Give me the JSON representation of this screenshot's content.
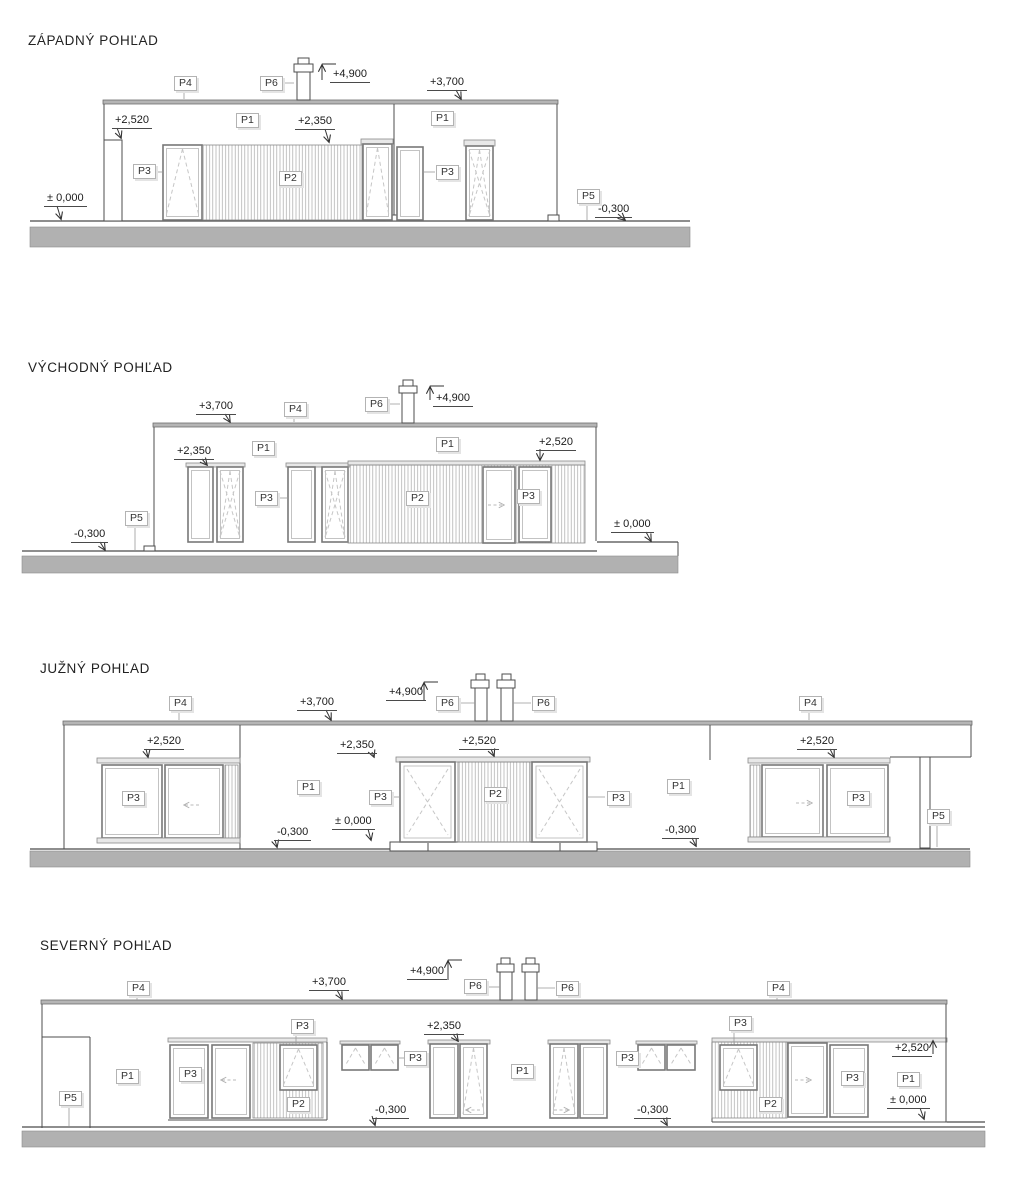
{
  "drawing": {
    "type": "building-elevations",
    "sheet_background": "#ffffff"
  },
  "colors": {
    "line": "#4d4d4d",
    "frame": "#787878",
    "frame_inner": "#bdbdbd",
    "hatch": "#a8a8a8",
    "dash": "#c6c6c6",
    "ground": "#b1b1b1",
    "roof": "#b5b5b5",
    "leader": "#999999",
    "arrow": "#333333",
    "label_border": "#b3b3b3",
    "label_text": "#333333",
    "text": "#1a1a1a"
  },
  "elevations": [
    {
      "name": "west",
      "title": "ZÁPADNÝ POHĽAD",
      "plabels": [
        {
          "text": "P4",
          "x": 174,
          "y": 76
        },
        {
          "text": "P6",
          "x": 260,
          "y": 76
        },
        {
          "text": "P1",
          "x": 236,
          "y": 113
        },
        {
          "text": "P1",
          "x": 431,
          "y": 111
        },
        {
          "text": "P3",
          "x": 133,
          "y": 164
        },
        {
          "text": "P2",
          "x": 279,
          "y": 171
        },
        {
          "text": "P3",
          "x": 436,
          "y": 165
        },
        {
          "text": "P5",
          "x": 577,
          "y": 189
        }
      ],
      "dims": [
        {
          "text": "+4,900",
          "x": 330,
          "y": 68
        },
        {
          "text": "+3,700",
          "x": 427,
          "y": 76
        },
        {
          "text": "+2,520",
          "x": 112,
          "y": 114
        },
        {
          "text": "+2,350",
          "x": 295,
          "y": 115
        },
        {
          "text": "± 0,000",
          "x": 44,
          "y": 192
        },
        {
          "text": "-0,300",
          "x": 595,
          "y": 203
        }
      ]
    },
    {
      "name": "east",
      "title": "VÝCHODNÝ POHĽAD",
      "plabels": [
        {
          "text": "P4",
          "x": 284,
          "y": 402
        },
        {
          "text": "P6",
          "x": 365,
          "y": 397
        },
        {
          "text": "P1",
          "x": 252,
          "y": 441
        },
        {
          "text": "P1",
          "x": 436,
          "y": 437
        },
        {
          "text": "P5",
          "x": 125,
          "y": 511
        },
        {
          "text": "P3",
          "x": 255,
          "y": 491
        },
        {
          "text": "P2",
          "x": 406,
          "y": 491
        },
        {
          "text": "P3",
          "x": 517,
          "y": 489
        }
      ],
      "dims": [
        {
          "text": "+3,700",
          "x": 196,
          "y": 400
        },
        {
          "text": "+4,900",
          "x": 433,
          "y": 392
        },
        {
          "text": "+2,350",
          "x": 174,
          "y": 445
        },
        {
          "text": "+2,520",
          "x": 536,
          "y": 436
        },
        {
          "text": "-0,300",
          "x": 71,
          "y": 528
        },
        {
          "text": "± 0,000",
          "x": 611,
          "y": 518
        }
      ]
    },
    {
      "name": "south",
      "title": "JUŽNÝ POHĽAD",
      "plabels": [
        {
          "text": "P4",
          "x": 169,
          "y": 696
        },
        {
          "text": "P6",
          "x": 436,
          "y": 696
        },
        {
          "text": "P6",
          "x": 532,
          "y": 696
        },
        {
          "text": "P4",
          "x": 799,
          "y": 696
        },
        {
          "text": "P3",
          "x": 122,
          "y": 791
        },
        {
          "text": "P1",
          "x": 297,
          "y": 780
        },
        {
          "text": "P3",
          "x": 369,
          "y": 790
        },
        {
          "text": "P2",
          "x": 484,
          "y": 787
        },
        {
          "text": "P3",
          "x": 607,
          "y": 791
        },
        {
          "text": "P1",
          "x": 667,
          "y": 779
        },
        {
          "text": "P3",
          "x": 847,
          "y": 791
        },
        {
          "text": "P5",
          "x": 927,
          "y": 809
        }
      ],
      "dims": [
        {
          "text": "+3,700",
          "x": 297,
          "y": 696
        },
        {
          "text": "+4,900",
          "x": 386,
          "y": 686
        },
        {
          "text": "+2,520",
          "x": 144,
          "y": 735
        },
        {
          "text": "+2,350",
          "x": 337,
          "y": 739
        },
        {
          "text": "+2,520",
          "x": 459,
          "y": 735
        },
        {
          "text": "+2,520",
          "x": 797,
          "y": 735
        },
        {
          "text": "± 0,000",
          "x": 332,
          "y": 815
        },
        {
          "text": "-0,300",
          "x": 274,
          "y": 826
        },
        {
          "text": "-0,300",
          "x": 662,
          "y": 824
        }
      ]
    },
    {
      "name": "north",
      "title": "SEVERNÝ POHĽAD",
      "plabels": [
        {
          "text": "P4",
          "x": 127,
          "y": 981
        },
        {
          "text": "P6",
          "x": 464,
          "y": 979
        },
        {
          "text": "P6",
          "x": 556,
          "y": 981
        },
        {
          "text": "P4",
          "x": 767,
          "y": 981
        },
        {
          "text": "P5",
          "x": 59,
          "y": 1091
        },
        {
          "text": "P1",
          "x": 116,
          "y": 1069
        },
        {
          "text": "P3",
          "x": 179,
          "y": 1067
        },
        {
          "text": "P3",
          "x": 291,
          "y": 1019
        },
        {
          "text": "P2",
          "x": 287,
          "y": 1097
        },
        {
          "text": "P3",
          "x": 404,
          "y": 1051
        },
        {
          "text": "P1",
          "x": 511,
          "y": 1064
        },
        {
          "text": "P3",
          "x": 616,
          "y": 1051
        },
        {
          "text": "P3",
          "x": 729,
          "y": 1016
        },
        {
          "text": "P2",
          "x": 759,
          "y": 1097
        },
        {
          "text": "P3",
          "x": 841,
          "y": 1071
        },
        {
          "text": "P1",
          "x": 897,
          "y": 1072
        }
      ],
      "dims": [
        {
          "text": "+3,700",
          "x": 309,
          "y": 976
        },
        {
          "text": "+4,900",
          "x": 407,
          "y": 965
        },
        {
          "text": "+2,350",
          "x": 424,
          "y": 1020
        },
        {
          "text": "+2,520",
          "x": 892,
          "y": 1042
        },
        {
          "text": "± 0,000",
          "x": 887,
          "y": 1094
        },
        {
          "text": "-0,300",
          "x": 372,
          "y": 1104
        },
        {
          "text": "-0,300",
          "x": 634,
          "y": 1104
        }
      ]
    }
  ]
}
